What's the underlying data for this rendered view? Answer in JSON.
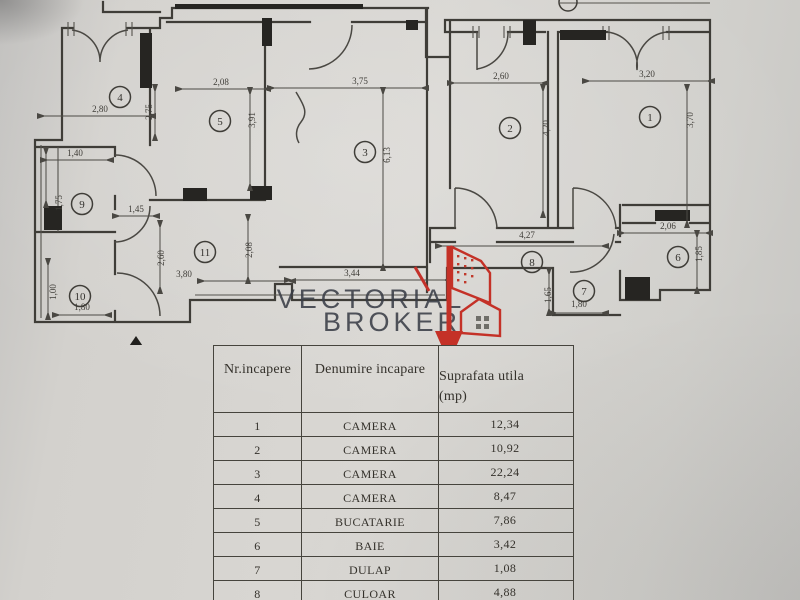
{
  "document": {
    "kind": "apartment floor plan scan"
  },
  "watermark": {
    "line1": "VECTORIAL",
    "line2": "BROKER"
  },
  "table": {
    "headers": {
      "col1": "Nr.incapere",
      "col2": "Denumire incapare",
      "col3": "Suprafata utila",
      "col3_unit": "(mp)"
    },
    "rows": [
      {
        "nr": "1",
        "name": "CAMERA",
        "area": "12,34"
      },
      {
        "nr": "2",
        "name": "CAMERA",
        "area": "10,92"
      },
      {
        "nr": "3",
        "name": "CAMERA",
        "area": "22,24"
      },
      {
        "nr": "4",
        "name": "CAMERA",
        "area": "8,47"
      },
      {
        "nr": "5",
        "name": "BUCATARIE",
        "area": "7,86"
      },
      {
        "nr": "6",
        "name": "BAIE",
        "area": "3,42"
      },
      {
        "nr": "7",
        "name": "DULAP",
        "area": "1,08"
      },
      {
        "nr": "8",
        "name": "CULOAR",
        "area": "4,88"
      }
    ]
  },
  "plan": {
    "rooms": [
      {
        "n": "1",
        "x": 650,
        "y": 117
      },
      {
        "n": "2",
        "x": 510,
        "y": 128
      },
      {
        "n": "3",
        "x": 365,
        "y": 152
      },
      {
        "n": "4",
        "x": 120,
        "y": 97
      },
      {
        "n": "5",
        "x": 220,
        "y": 121
      },
      {
        "n": "6",
        "x": 678,
        "y": 257
      },
      {
        "n": "7",
        "x": 584,
        "y": 291
      },
      {
        "n": "8",
        "x": 532,
        "y": 262
      },
      {
        "n": "9",
        "x": 82,
        "y": 204
      },
      {
        "n": "10",
        "x": 80,
        "y": 296
      },
      {
        "n": "11",
        "x": 205,
        "y": 252
      }
    ],
    "dimensions": [
      {
        "label": "2,80",
        "x": 100,
        "y": 112,
        "rot": 0
      },
      {
        "label": "2,75",
        "x": 152,
        "y": 112,
        "rot": -90
      },
      {
        "label": "1,40",
        "x": 75,
        "y": 156,
        "rot": 0
      },
      {
        "label": "1,75",
        "x": 62,
        "y": 203,
        "rot": -90
      },
      {
        "label": "1,45",
        "x": 136,
        "y": 212,
        "rot": 0
      },
      {
        "label": "1,00",
        "x": 56,
        "y": 292,
        "rot": -90
      },
      {
        "label": "1,80",
        "x": 82,
        "y": 310,
        "rot": 0
      },
      {
        "label": "2,60",
        "x": 164,
        "y": 258,
        "rot": -90
      },
      {
        "label": "3,80",
        "x": 184,
        "y": 277,
        "rot": 0
      },
      {
        "label": "2,08",
        "x": 252,
        "y": 250,
        "rot": -90
      },
      {
        "label": "3,44",
        "x": 352,
        "y": 276,
        "rot": 0
      },
      {
        "label": "2,08",
        "x": 221,
        "y": 85,
        "rot": 0
      },
      {
        "label": "3,91",
        "x": 255,
        "y": 120,
        "rot": -90
      },
      {
        "label": "3,75",
        "x": 360,
        "y": 84,
        "rot": 0
      },
      {
        "label": "6,13",
        "x": 390,
        "y": 155,
        "rot": -90
      },
      {
        "label": "2,60",
        "x": 501,
        "y": 79,
        "rot": 0
      },
      {
        "label": "4,20",
        "x": 549,
        "y": 128,
        "rot": -90
      },
      {
        "label": "3,20",
        "x": 647,
        "y": 77,
        "rot": 0
      },
      {
        "label": "3,70",
        "x": 693,
        "y": 120,
        "rot": -90
      },
      {
        "label": "4,27",
        "x": 527,
        "y": 238,
        "rot": 0
      },
      {
        "label": "2,06",
        "x": 668,
        "y": 229,
        "rot": 0
      },
      {
        "label": "1,85",
        "x": 702,
        "y": 254,
        "rot": -90
      },
      {
        "label": "1,65",
        "x": 551,
        "y": 295,
        "rot": -90
      },
      {
        "label": "1,80",
        "x": 579,
        "y": 307,
        "rot": 0
      }
    ]
  },
  "colors": {
    "paper": "#d3d1cd",
    "ink": "#3f3d38",
    "red": "#c43127"
  }
}
